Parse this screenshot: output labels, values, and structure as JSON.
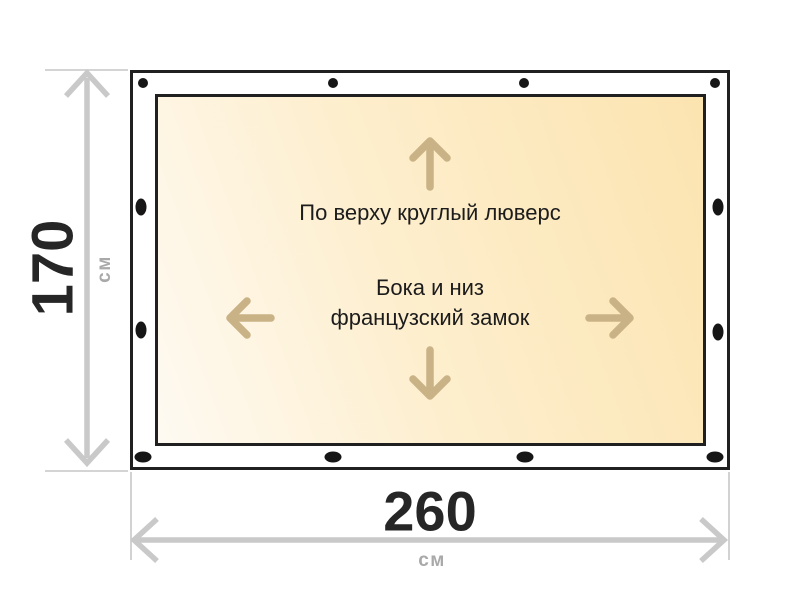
{
  "diagram": {
    "panel_labels": {
      "top_note": "По верху круглый люверс",
      "middle_note_line1": "Бока и низ",
      "middle_note_line2": "французский замок"
    },
    "dimensions": {
      "height": {
        "value": "170",
        "unit": "см"
      },
      "width": {
        "value": "260",
        "unit": "см"
      }
    },
    "grommets": {
      "top_count": 4,
      "bottom_count": 4,
      "left_count": 2,
      "right_count": 2
    },
    "icons": {
      "up": "arrow-up-icon",
      "down": "arrow-down-icon",
      "left": "arrow-left-icon",
      "right": "arrow-right-icon"
    },
    "colors": {
      "outline": "#202020",
      "grommet": "#161616",
      "dimension_gray": "#c9c9c9",
      "guide_gray": "#c6c6c6",
      "unit_text_gray": "#a9a9a9",
      "number_text": "#262626",
      "note_text": "#1c1c1c",
      "direction_arrow_tan": "#c9b286",
      "panel_fill_light": "#fefaf2",
      "panel_fill_dark": "#fce4b0"
    }
  }
}
